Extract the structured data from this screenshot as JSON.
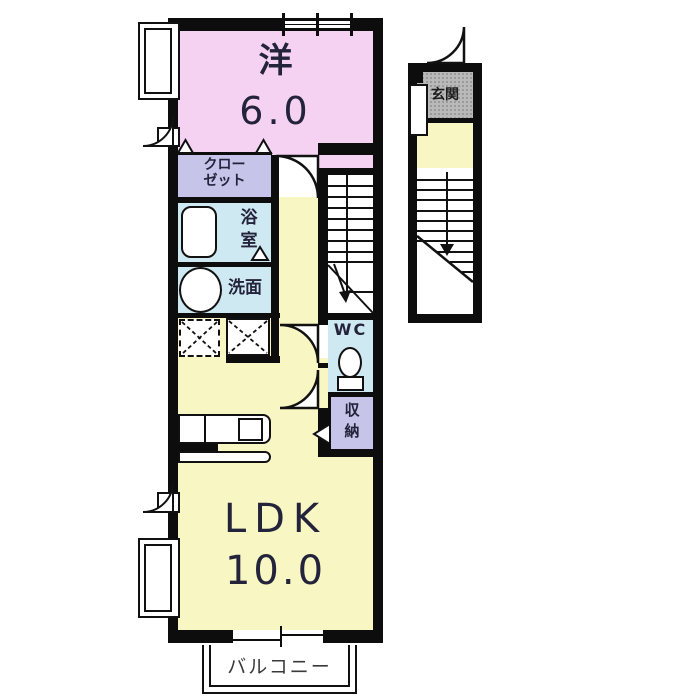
{
  "plan_title": "apartment-floor-plan",
  "rooms": {
    "western": {
      "name": "洋",
      "size": "6.0"
    },
    "closet": {
      "line1": "クロー",
      "line2": "ゼット"
    },
    "bath": {
      "char1": "浴",
      "char2": "室"
    },
    "washroom": {
      "label": "洗面"
    },
    "wc": {
      "label": "WC"
    },
    "storage": {
      "char1": "収",
      "char2": "納"
    },
    "ldk": {
      "name": "LDK",
      "size": "10.0"
    },
    "entrance": {
      "label": "玄関"
    },
    "balcony": {
      "label": "バルコニー"
    }
  },
  "colors": {
    "wall": "#0d0d0d",
    "western_room": "#f6d2f2",
    "closet_storage": "#c6c5e9",
    "wet_rooms": "#cfe9f2",
    "ldk_hall": "#f8f6c3",
    "entrance_floor": "#b9b9b9",
    "text": "#23233b"
  }
}
